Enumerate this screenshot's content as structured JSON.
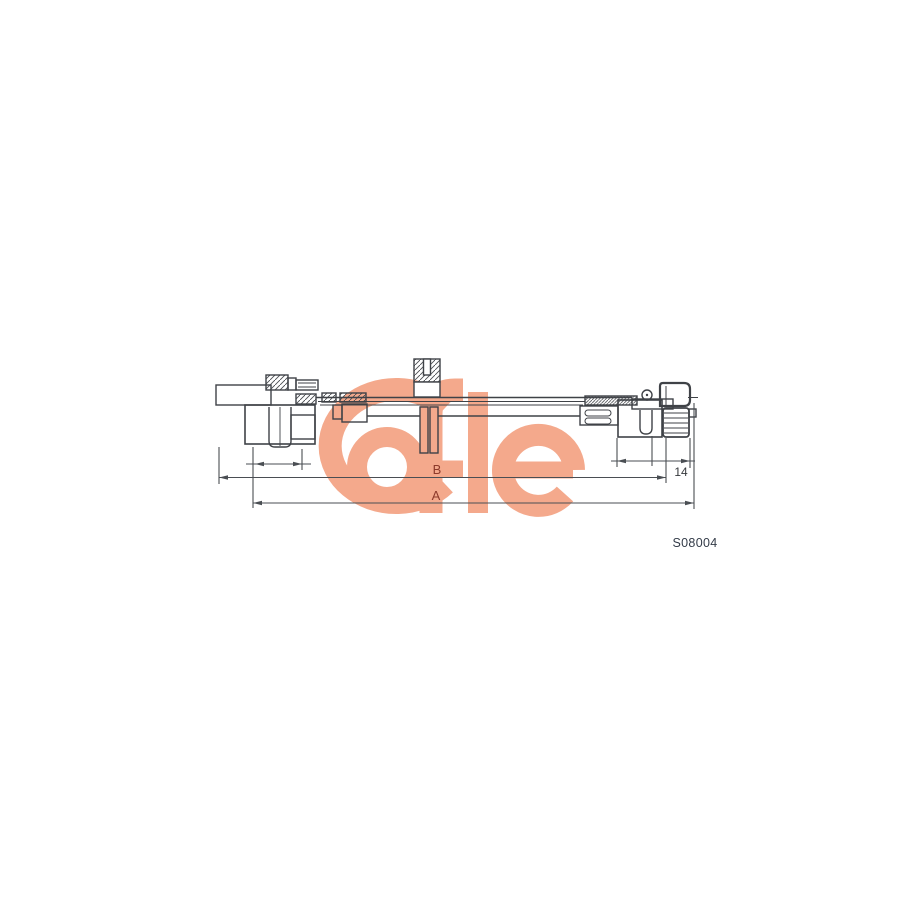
{
  "diagram": {
    "type": "technical line drawing of a speedometer shaft cable",
    "part_number": "S08004",
    "brand": "Cofle",
    "labels": {
      "dim_a": "A",
      "dim_b": "B",
      "dim_offset": "14"
    },
    "colors": {
      "watermark_salmon": "#f4a98c",
      "line_art": "#3f4247",
      "dimension_label": "#8d3a2b",
      "offset_label": "#36393d",
      "part_number_text": "#333b48",
      "background": "#ffffff"
    }
  }
}
